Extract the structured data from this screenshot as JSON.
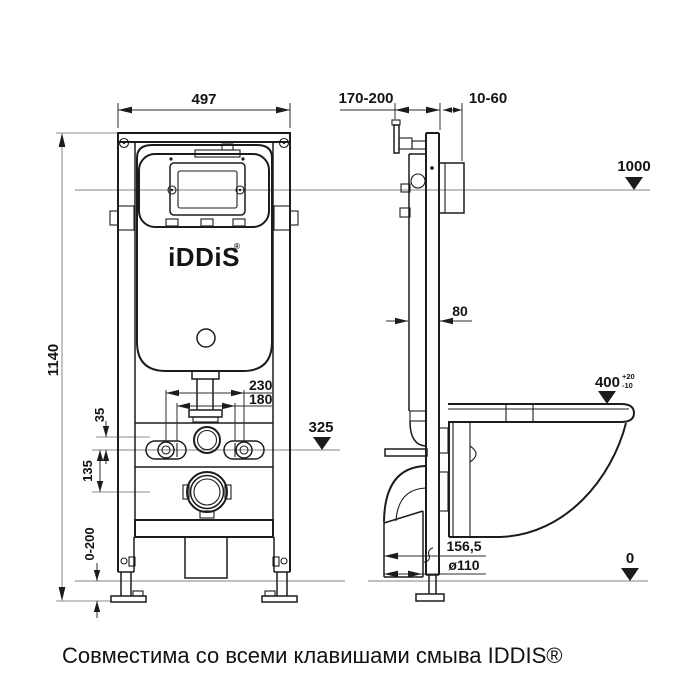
{
  "palette": {
    "background": "#ffffff",
    "ink": "#1c1c1c",
    "guide": "#9c9c9c",
    "dim": "#2e2e2e",
    "text": "#141414"
  },
  "caption": {
    "text": "Совместима со всеми клавишами смыва IDDIS®"
  },
  "cistern": {
    "logo": "iDDiS",
    "logo_mark": "®"
  },
  "levels": {
    "top": "1000",
    "studs": "325",
    "floor": "0"
  },
  "front_view": {
    "dims": {
      "frame_width": "497",
      "frame_height": "1140",
      "stud_spacing_outer": "230",
      "stud_spacing_inner": "180",
      "inlet_to_studs": "35",
      "studs_to_drain": "135",
      "leg_adjust_range": "0-200"
    }
  },
  "side_view": {
    "dims": {
      "wall_offset_range": "170-200",
      "finish_thickness": "10-60",
      "profile_depth": "80",
      "bowl_height": "400",
      "bowl_height_tol_plus": "+20",
      "bowl_height_tol_minus": "-10",
      "drain_offset": "156,5",
      "drain_diameter": "ø110"
    }
  }
}
